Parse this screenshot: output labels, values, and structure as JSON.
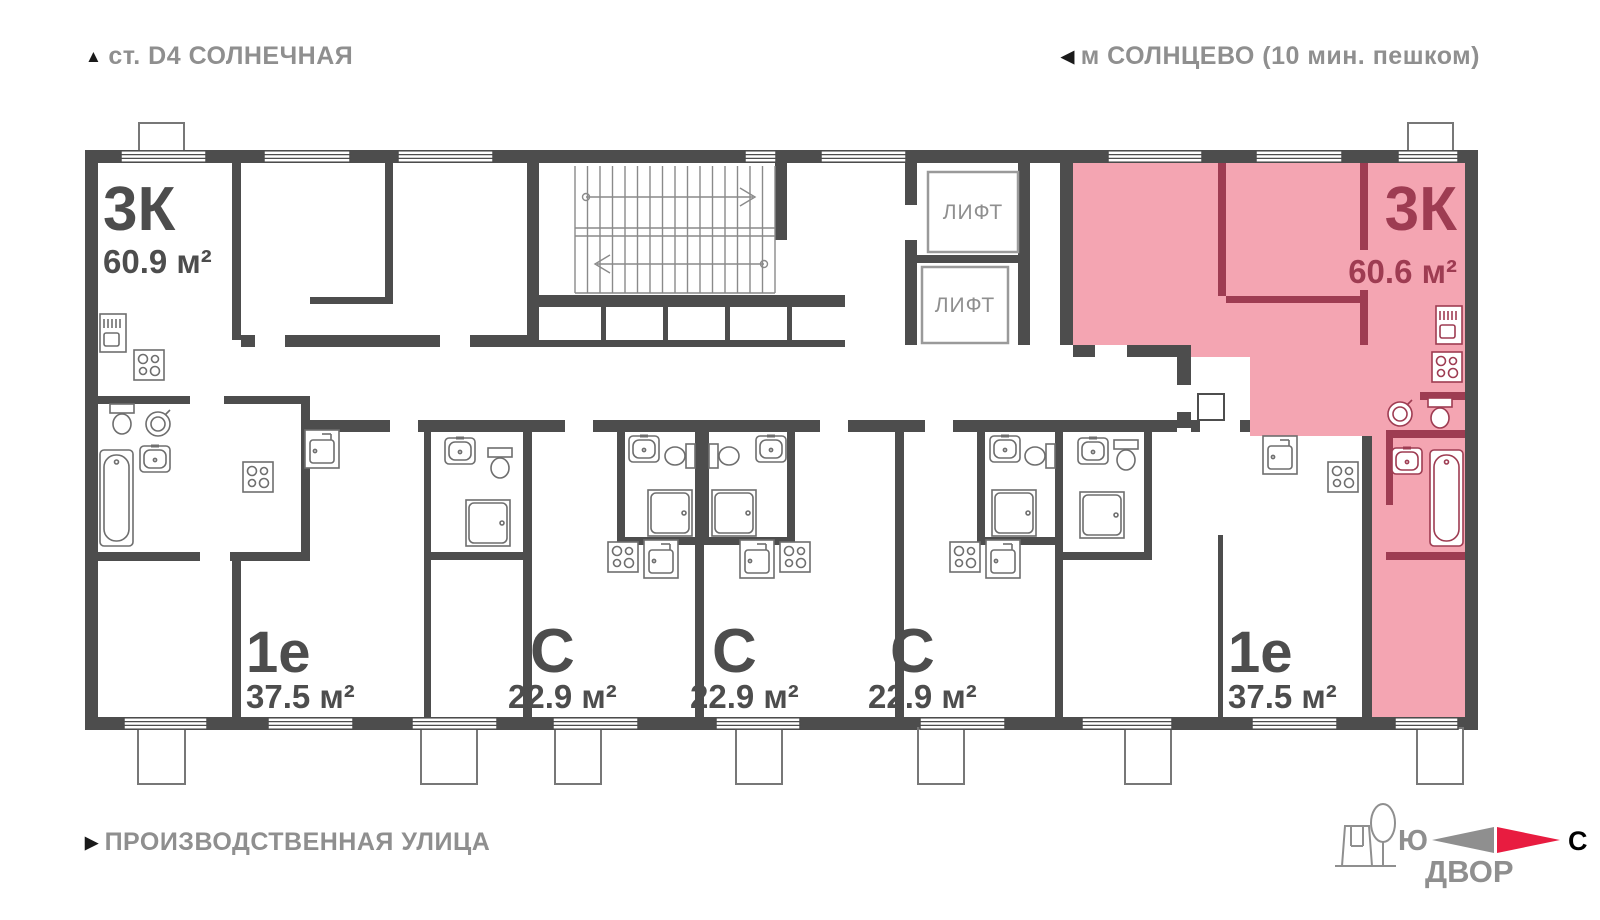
{
  "markers": {
    "up": "▲",
    "left": "◀",
    "right": "▶"
  },
  "header": {
    "station": "ст. D4 СОЛНЕЧНАЯ",
    "metro": "м СОЛНЦЕВО (10 мин. пешком)"
  },
  "footer": {
    "street": "ПРОИЗВОДСТВЕННАЯ УЛИЦА",
    "courtyard": "ДВОР",
    "south": "Ю",
    "north": "С"
  },
  "core": {
    "elevator_1": "ЛИФТ",
    "elevator_2": "ЛИФТ"
  },
  "units": [
    {
      "id": "unit-3k-left",
      "type_label": "3К",
      "area_label": "60.9 м²",
      "highlighted": false
    },
    {
      "id": "unit-1e-left",
      "type_label": "1е",
      "area_label": "37.5 м²",
      "highlighted": false
    },
    {
      "id": "unit-c-1",
      "type_label": "С",
      "area_label": "22.9 м²",
      "highlighted": false
    },
    {
      "id": "unit-c-2",
      "type_label": "С",
      "area_label": "22.9 м²",
      "highlighted": false
    },
    {
      "id": "unit-c-3",
      "type_label": "С",
      "area_label": "22.9 м²",
      "highlighted": false
    },
    {
      "id": "unit-1e-right",
      "type_label": "1е",
      "area_label": "37.5 м²",
      "highlighted": false
    },
    {
      "id": "unit-3k-right",
      "type_label": "3К",
      "area_label": "60.6 м²",
      "highlighted": true
    }
  ],
  "colors": {
    "wall": "#4d4d4d",
    "highlight_fill": "#f4a5b2",
    "highlight_wall": "#9e3c52",
    "accent_red": "#e81c40",
    "muted_text": "#8f8f8f"
  }
}
